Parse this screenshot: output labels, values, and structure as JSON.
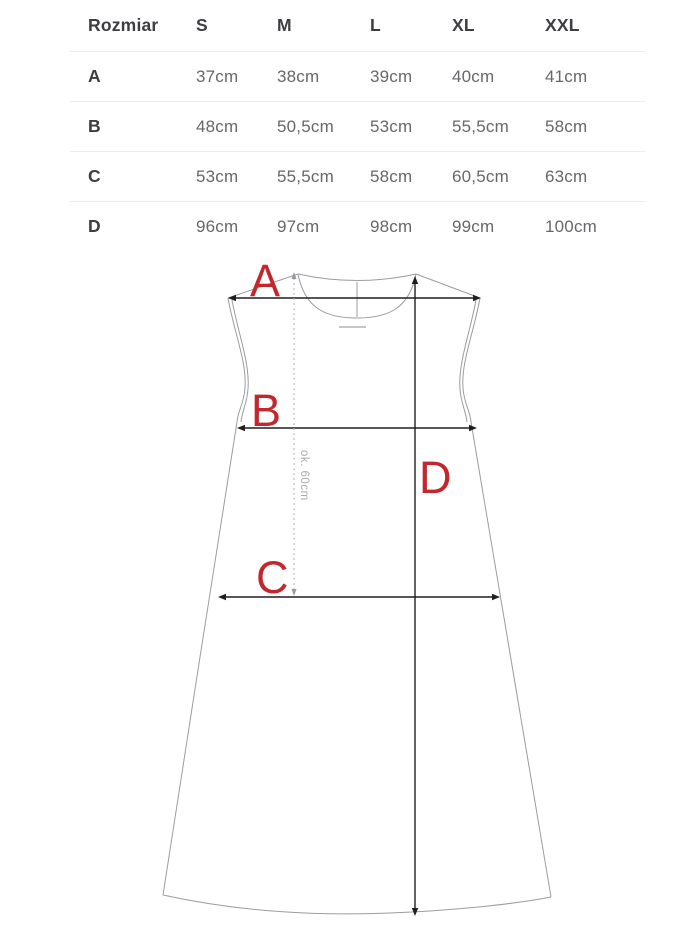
{
  "page": {
    "background": "#ffffff"
  },
  "chart_data": {
    "type": "table",
    "columns": [
      "Rozmiar",
      "S",
      "M",
      "L",
      "XL",
      "XXL"
    ],
    "rows": [
      [
        "A",
        "37cm",
        "38cm",
        "39cm",
        "40cm",
        "41cm"
      ],
      [
        "B",
        "48cm",
        "50,5cm",
        "53cm",
        "55,5cm",
        "58cm"
      ],
      [
        "C",
        "53cm",
        "55,5cm",
        "58cm",
        "60,5cm",
        "63cm"
      ],
      [
        "D",
        "96cm",
        "97cm",
        "98cm",
        "99cm",
        "100cm"
      ]
    ]
  },
  "diagram": {
    "type": "garment-measurement-sketch",
    "measure_labels": {
      "a": "A",
      "b": "B",
      "c": "C",
      "d": "D"
    },
    "length_note": "ok. 60cm",
    "colors": {
      "accent_red": "#c1272d",
      "dimension_line": "#1f1f1f",
      "outline_gray": "#9c9ca1",
      "note_gray": "#ababab",
      "separator": "#ededee"
    }
  }
}
